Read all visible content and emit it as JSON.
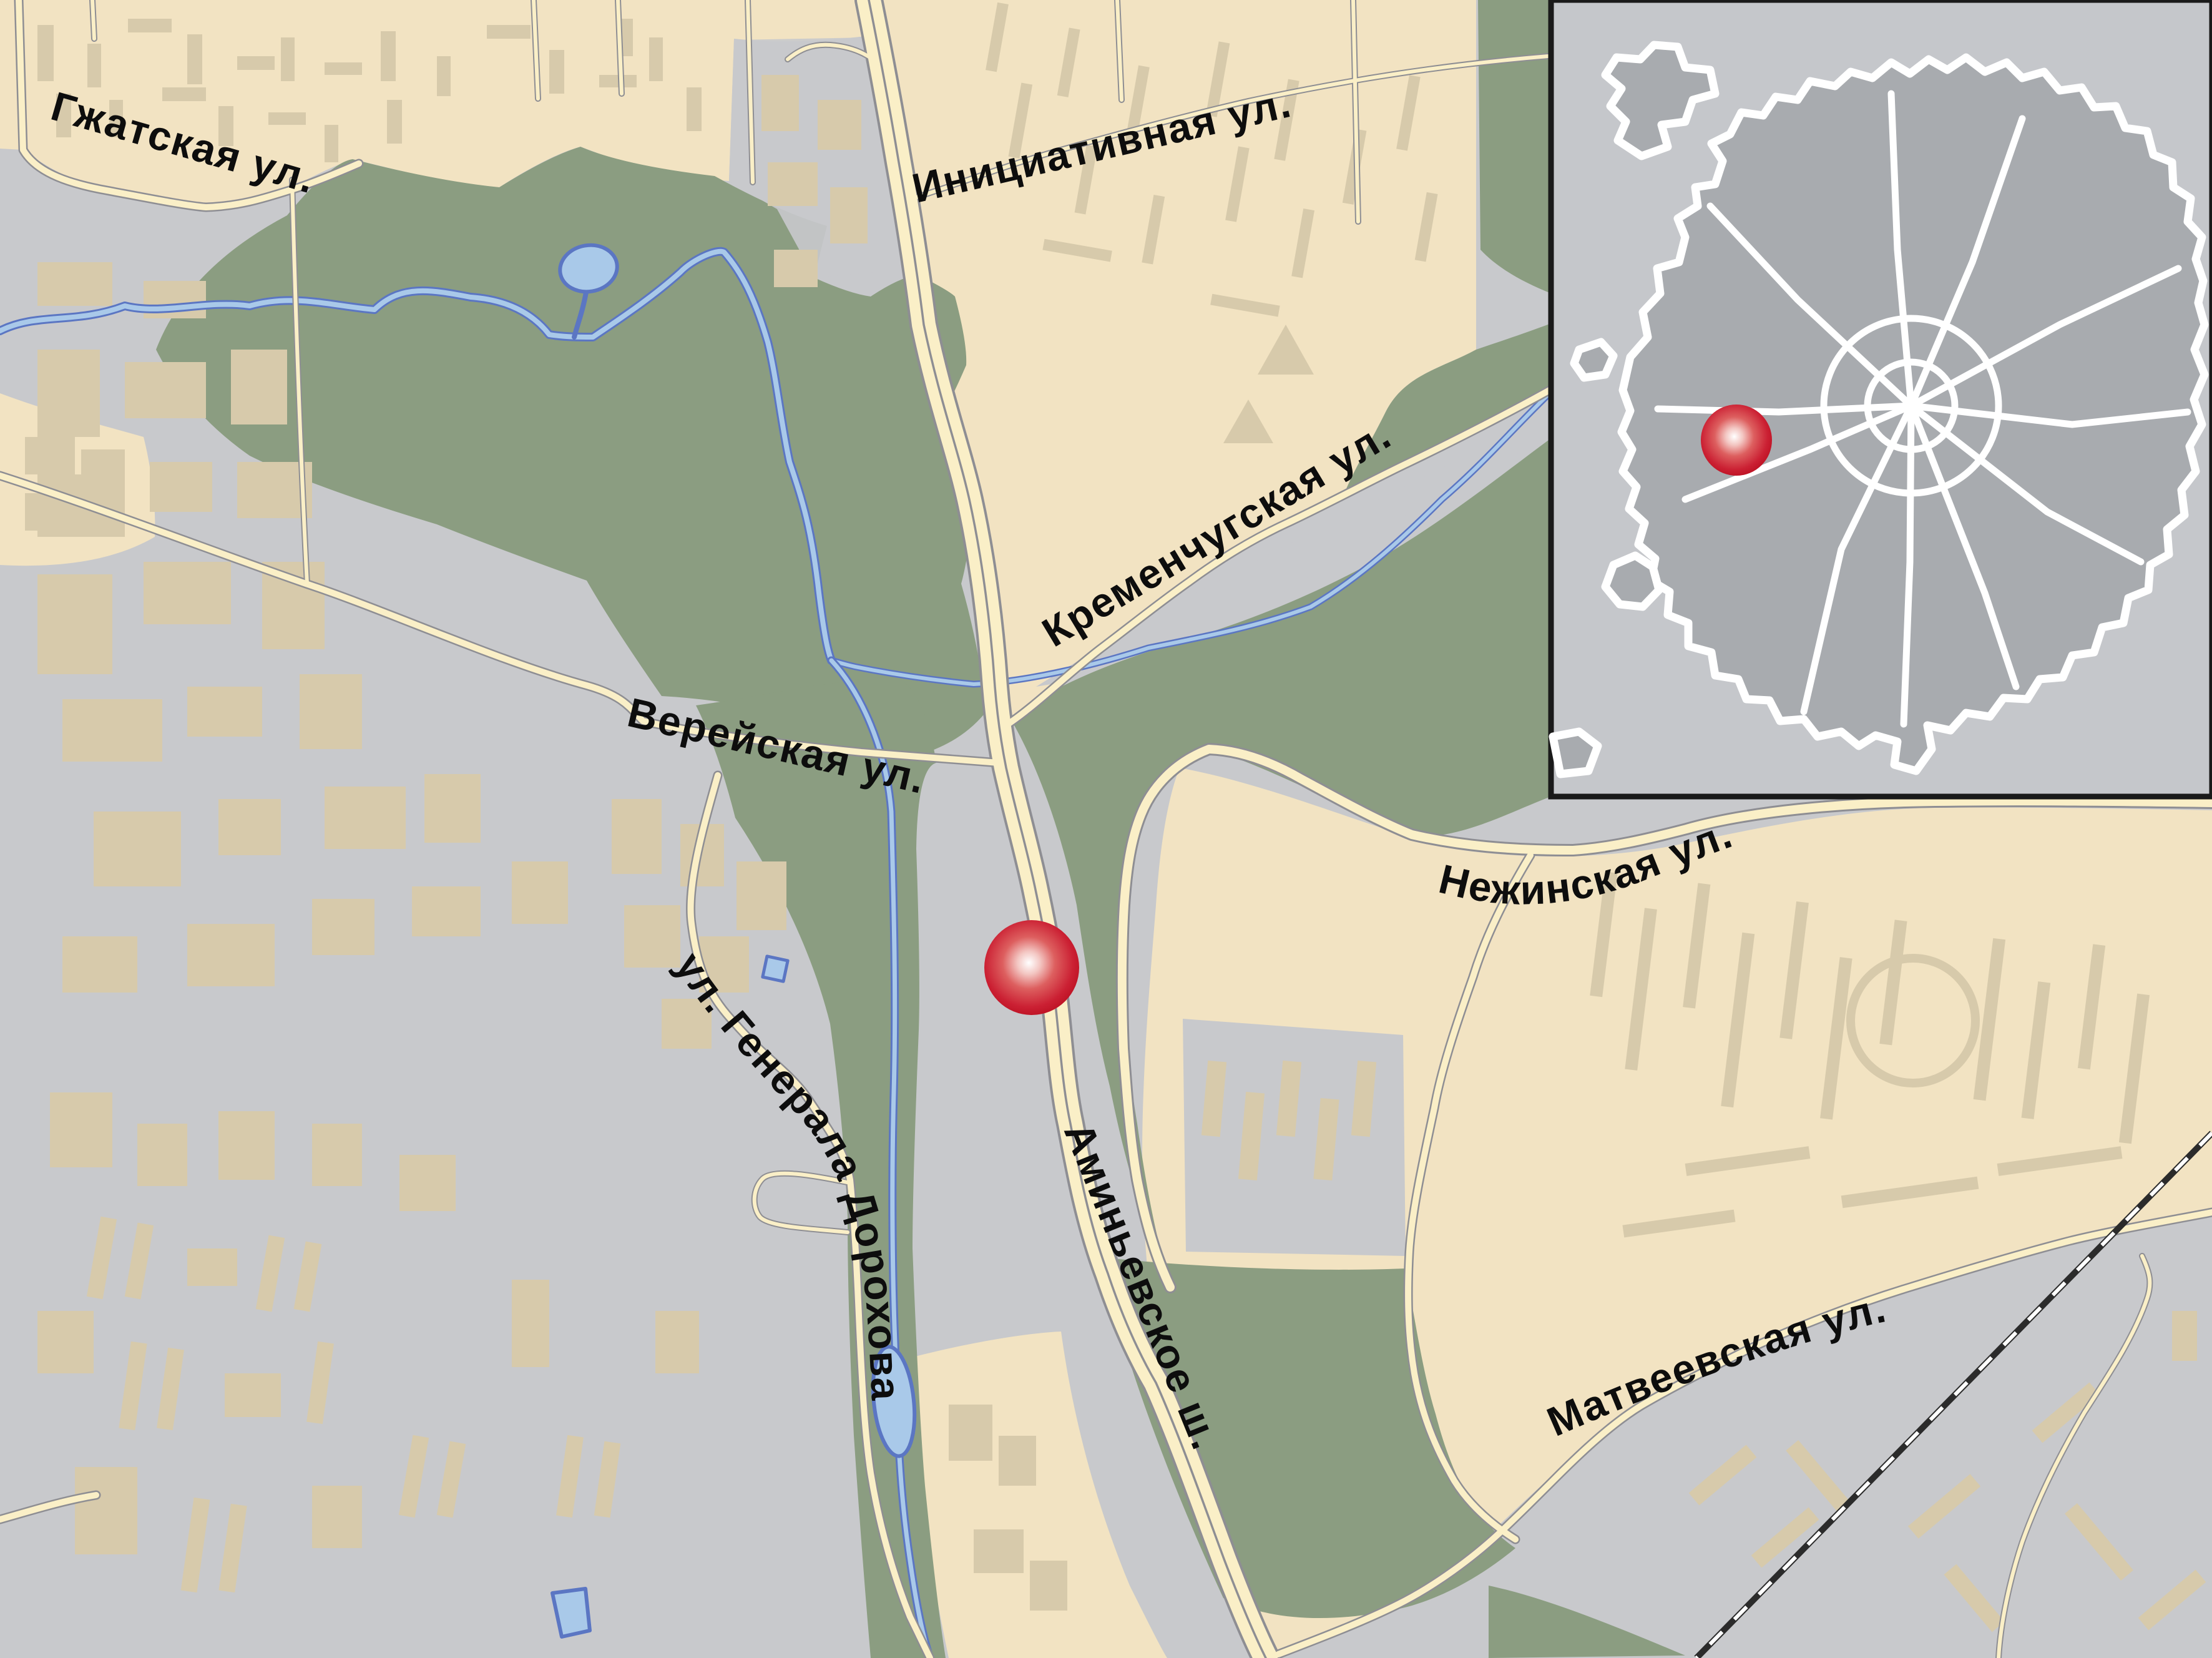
{
  "map": {
    "type": "city-street-map",
    "language": "Russian",
    "street_labels": {
      "gzhatskaya": "Гжатская ул.",
      "initsiativnaya": "Инициативная ул.",
      "kremenchugskaya": "Кременчугская ул.",
      "vereyskaya": "Верейская ул.",
      "nezhinskaya": "Нежинская ул.",
      "dorokhova": "ул. Генерала Дорохова",
      "aminyevskoye": "Аминьевское ш.",
      "matveyevskaya": "Матвеевская ул."
    },
    "markers": {
      "main": {
        "shape": "circle",
        "color": "#c51f2f",
        "style": "radial-highlight"
      },
      "inset": {
        "shape": "circle",
        "color": "#c51f2f",
        "style": "radial-highlight"
      }
    },
    "palette": {
      "residential": "#f2e3c2",
      "industrial_gray": "#c8c9cc",
      "building": "#d7caab",
      "park_green": "#8b9d81",
      "water_fill": "#a9c9e9",
      "water_edge": "#5b76c3",
      "road_fill": "#faefc7",
      "road_casing": "#8e8e93",
      "railway": "#2b2b2b",
      "label_text": "#0d0d0d",
      "inset_bg": "#c5c7cb",
      "inset_city": "#a8abaf",
      "inset_roads": "#ffffff",
      "inset_border": "#1a1a1a"
    },
    "inset": {
      "description": "overview-minimap-with-ring-roads",
      "has_marker": true
    }
  }
}
